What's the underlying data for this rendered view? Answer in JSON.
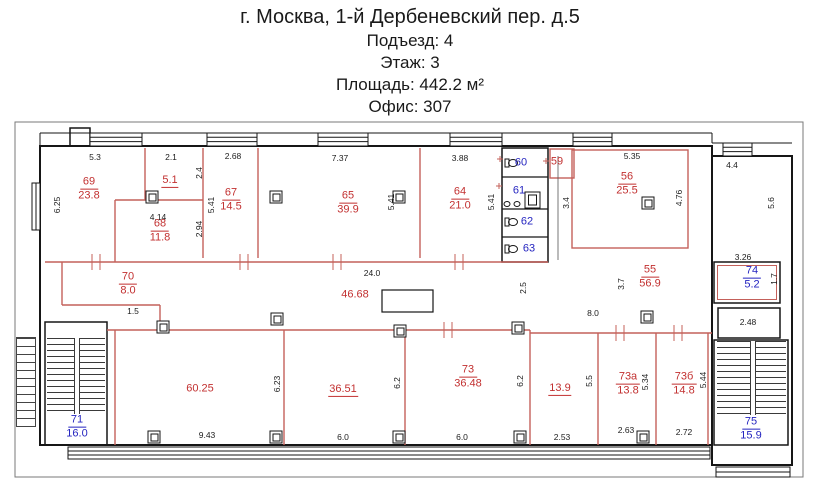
{
  "header": {
    "address": "г. Москва, 1-й Дербеневский пер. д.5",
    "entrance": "Подъезд: 4",
    "floor": "Этаж: 3",
    "area": "Площадь: 442.2 м²",
    "office": "Офис: 307"
  },
  "plan": {
    "colors": {
      "red": "#c23030",
      "blue": "#2525c0",
      "wall": "#161616",
      "partition": "#c4605a"
    },
    "rooms": [
      {
        "number": "69",
        "area": "23.8",
        "color": "red",
        "x": 89,
        "y": 189
      },
      {
        "area": "5.1",
        "color": "red",
        "x": 170,
        "y": 181,
        "underline": true
      },
      {
        "number": "68",
        "area": "11.8",
        "color": "red",
        "x": 160,
        "y": 231
      },
      {
        "number": "67",
        "area": "14.5",
        "color": "red",
        "x": 231,
        "y": 200
      },
      {
        "number": "65",
        "area": "39.9",
        "color": "red",
        "x": 348,
        "y": 203
      },
      {
        "number": "64",
        "area": "21.0",
        "color": "red",
        "x": 460,
        "y": 199
      },
      {
        "area": "59",
        "color": "red",
        "x": 557,
        "y": 162
      },
      {
        "number": "56",
        "area": "25.5",
        "color": "red",
        "x": 627,
        "y": 184
      },
      {
        "number": "55",
        "area": "56.9",
        "color": "red",
        "x": 650,
        "y": 277
      },
      {
        "number": "70",
        "area": "8.0",
        "color": "red",
        "x": 128,
        "y": 284
      },
      {
        "area": "46.68",
        "color": "red",
        "x": 355,
        "y": 295
      },
      {
        "area": "60.25",
        "color": "red",
        "x": 200,
        "y": 389
      },
      {
        "area": "36.51",
        "color": "red",
        "x": 343,
        "y": 390,
        "underline": true
      },
      {
        "number": "73",
        "area": "36.48",
        "color": "red",
        "x": 468,
        "y": 377
      },
      {
        "area": "13.9",
        "color": "red",
        "x": 560,
        "y": 389,
        "underline": true
      },
      {
        "number": "73а",
        "area": "13.8",
        "color": "red",
        "x": 628,
        "y": 384
      },
      {
        "number": "73б",
        "area": "14.8",
        "color": "red",
        "x": 684,
        "y": 384
      },
      {
        "area": "60",
        "color": "blue",
        "x": 521,
        "y": 163
      },
      {
        "area": "61",
        "color": "blue",
        "x": 519,
        "y": 191
      },
      {
        "area": "62",
        "color": "blue",
        "x": 527,
        "y": 222
      },
      {
        "area": "63",
        "color": "blue",
        "x": 529,
        "y": 249
      },
      {
        "number": "74",
        "area": "5.2",
        "color": "blue",
        "x": 752,
        "y": 278
      },
      {
        "number": "71",
        "area": "16.0",
        "color": "blue",
        "x": 77,
        "y": 427
      },
      {
        "number": "75",
        "area": "15.9",
        "color": "blue",
        "x": 751,
        "y": 429
      }
    ],
    "dims": [
      {
        "t": "5.3",
        "x": 95,
        "y": 157
      },
      {
        "t": "2.1",
        "x": 171,
        "y": 157
      },
      {
        "t": "2.68",
        "x": 233,
        "y": 156
      },
      {
        "t": "7.37",
        "x": 340,
        "y": 158
      },
      {
        "t": "3.88",
        "x": 460,
        "y": 158
      },
      {
        "t": "5.35",
        "x": 632,
        "y": 156
      },
      {
        "t": "4.4",
        "x": 732,
        "y": 165
      },
      {
        "t": "6.25",
        "x": 57,
        "y": 205,
        "v": 1
      },
      {
        "t": "2.4",
        "x": 199,
        "y": 173,
        "v": 1
      },
      {
        "t": "5.41",
        "x": 211,
        "y": 205,
        "v": 1
      },
      {
        "t": "2.94",
        "x": 199,
        "y": 229,
        "v": 1
      },
      {
        "t": "4.14",
        "x": 158,
        "y": 217
      },
      {
        "t": "5.41",
        "x": 391,
        "y": 202,
        "v": 1
      },
      {
        "t": "5.41",
        "x": 491,
        "y": 202,
        "v": 1
      },
      {
        "t": "3.4",
        "x": 566,
        "y": 203,
        "v": 1
      },
      {
        "t": "4.76",
        "x": 679,
        "y": 198,
        "v": 1
      },
      {
        "t": "5.6",
        "x": 771,
        "y": 203,
        "v": 1
      },
      {
        "t": "24.0",
        "x": 372,
        "y": 273
      },
      {
        "t": "2.5",
        "x": 523,
        "y": 288,
        "v": 1
      },
      {
        "t": "3.7",
        "x": 621,
        "y": 284,
        "v": 1
      },
      {
        "t": "8.0",
        "x": 593,
        "y": 313
      },
      {
        "t": "1.5",
        "x": 133,
        "y": 311
      },
      {
        "t": "3.26",
        "x": 743,
        "y": 257
      },
      {
        "t": "1.7",
        "x": 774,
        "y": 279,
        "v": 1
      },
      {
        "t": "2.48",
        "x": 748,
        "y": 322
      },
      {
        "t": "6.23",
        "x": 277,
        "y": 384,
        "v": 1
      },
      {
        "t": "6.2",
        "x": 397,
        "y": 383,
        "v": 1
      },
      {
        "t": "6.2",
        "x": 520,
        "y": 381,
        "v": 1
      },
      {
        "t": "5.5",
        "x": 589,
        "y": 381,
        "v": 1
      },
      {
        "t": "5.34",
        "x": 645,
        "y": 382,
        "v": 1
      },
      {
        "t": "5.44",
        "x": 703,
        "y": 380,
        "v": 1
      },
      {
        "t": "9.43",
        "x": 207,
        "y": 435
      },
      {
        "t": "6.0",
        "x": 343,
        "y": 437
      },
      {
        "t": "6.0",
        "x": 462,
        "y": 437
      },
      {
        "t": "2.53",
        "x": 562,
        "y": 437
      },
      {
        "t": "2.63",
        "x": 626,
        "y": 430
      },
      {
        "t": "2.72",
        "x": 684,
        "y": 432
      }
    ],
    "columns": [
      [
        152,
        197
      ],
      [
        276,
        197
      ],
      [
        399,
        197
      ],
      [
        648,
        203
      ],
      [
        163,
        327
      ],
      [
        277,
        319
      ],
      [
        400,
        331
      ],
      [
        518,
        328
      ],
      [
        647,
        317
      ],
      [
        154,
        437
      ],
      [
        276,
        437
      ],
      [
        399,
        437
      ],
      [
        520,
        437
      ],
      [
        643,
        437
      ]
    ]
  }
}
